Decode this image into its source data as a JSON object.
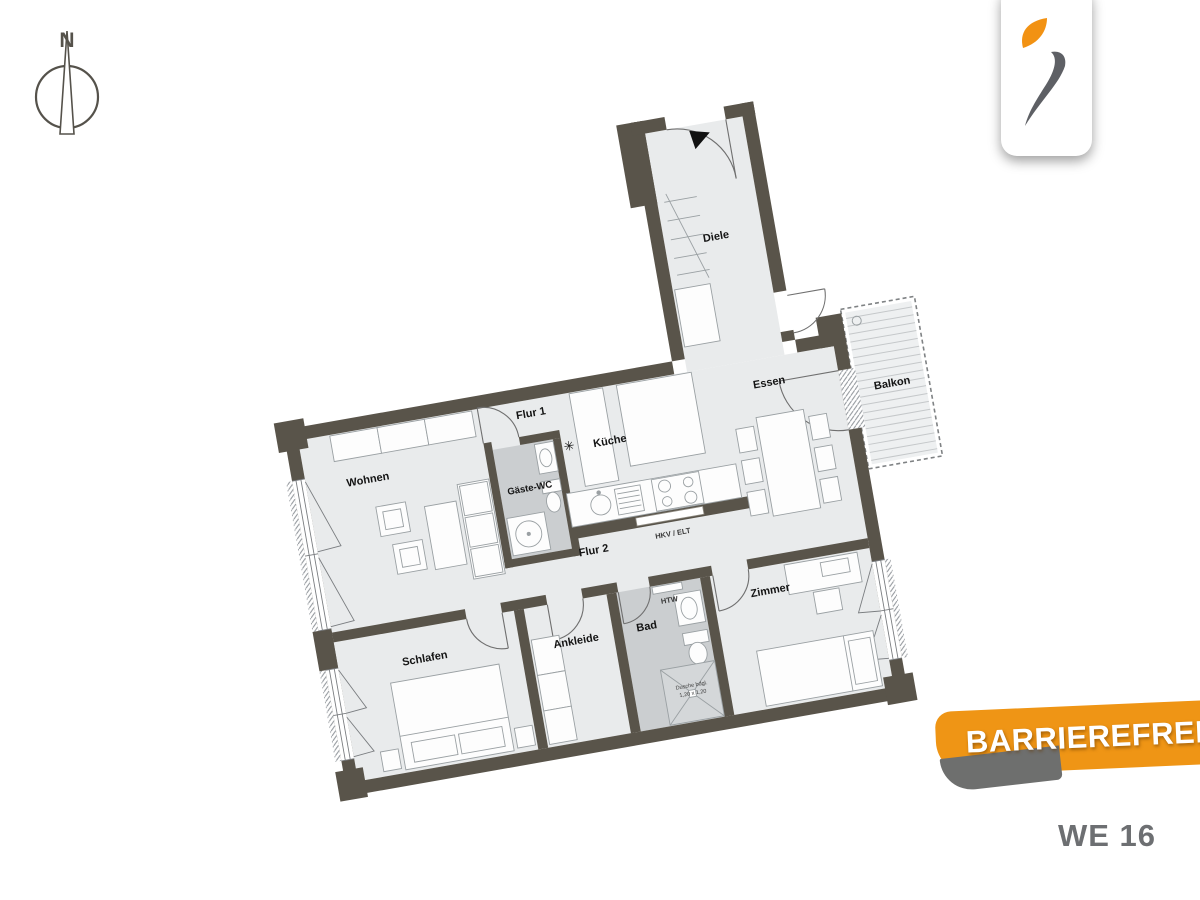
{
  "compass": {
    "north_label": "N"
  },
  "logo": {
    "colors": {
      "flame_orange": "#f29213",
      "swoosh_grey": "#5e6065"
    }
  },
  "floorplan": {
    "rooms": {
      "diele": "Diele",
      "wohnen": "Wohnen",
      "flur1": "Flur 1",
      "gaeste_wc": "Gäste-WC",
      "kueche": "Küche",
      "essen": "Essen",
      "balkon": "Balkon",
      "flur2": "Flur 2",
      "schlafen": "Schlafen",
      "ankleide": "Ankleide",
      "bad": "Bad",
      "zimmer": "Zimmer"
    },
    "annotations": {
      "hkv_elt": "HKV / ELT",
      "htw": "HTW",
      "shower_line1": "Dusche bdgl.",
      "shower_line2": "1,20 x 1,20",
      "freezer_symbol": "✳"
    },
    "colors": {
      "wall": "#59544a",
      "floor": "#e9ebec",
      "wet_floor": "#cbced0",
      "shower_floor": "#d4d7d9",
      "balcony_floor": "#eef0f1"
    }
  },
  "banner": {
    "label": "BARRIEREFREI",
    "color": "#ef9515"
  },
  "unit": {
    "label": "WE 16"
  }
}
